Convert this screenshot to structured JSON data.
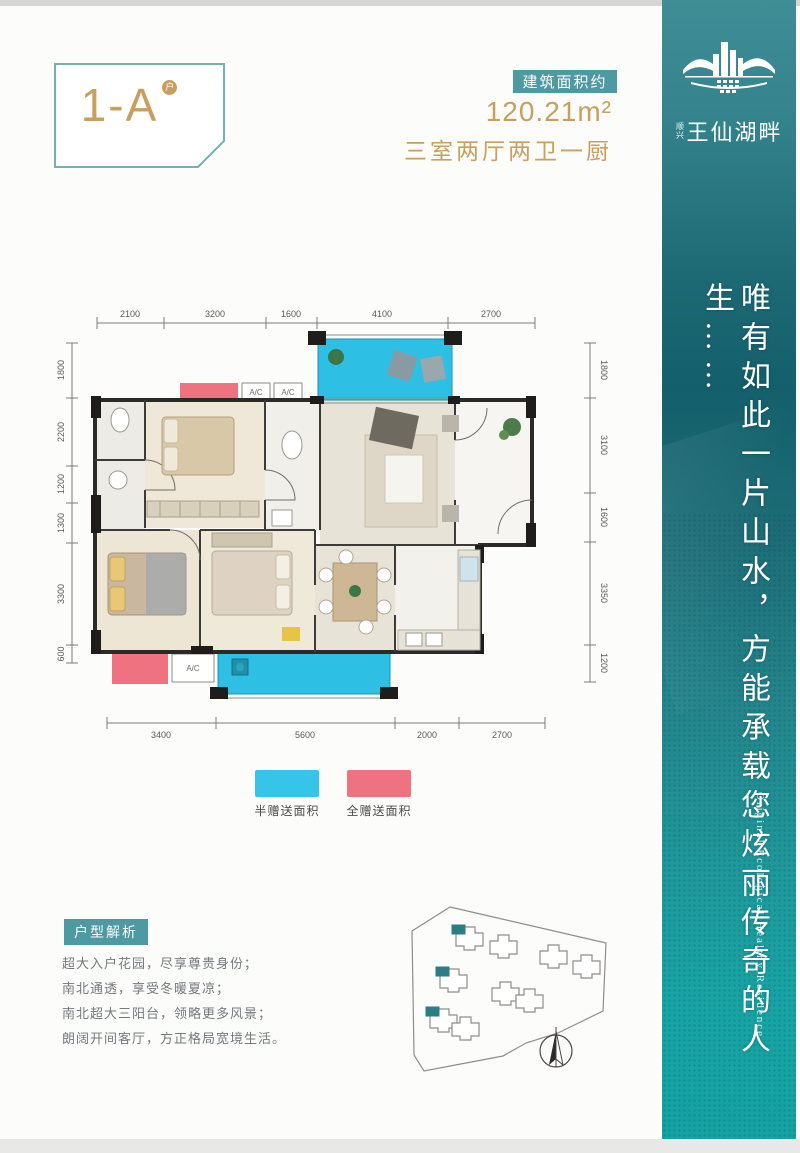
{
  "header": {
    "unit_label": "1-A",
    "unit_mark": "户",
    "area_badge": "建筑面积约",
    "area_value": "120.21m²",
    "rooms_desc": "三室两厅两卫一厨"
  },
  "brand": {
    "prefix": "顺兴",
    "name": "王仙湖畔",
    "slogan_cn": "唯有如此一片山水，方能承载您炫丽传奇的人生……",
    "slogan_en": "Original Ecological Healthy Residence"
  },
  "floorplan": {
    "ac_label": "A/C",
    "dims_top": [
      "2100",
      "3200",
      "1600",
      "4100",
      "2700"
    ],
    "dims_bottom": [
      "3400",
      "5600",
      "2000",
      "2700"
    ],
    "dims_left": [
      "1800",
      "2200",
      "1200",
      "1300",
      "3300",
      "600"
    ],
    "dims_right": [
      "1800",
      "3100",
      "1600",
      "3350",
      "1200"
    ]
  },
  "legend": {
    "items": [
      {
        "label": "半赠送面积",
        "color": "#35c5e8"
      },
      {
        "label": "全赠送面积",
        "color": "#ee7280"
      }
    ]
  },
  "analysis": {
    "title": "户型解析",
    "points": [
      "超大入户花园，尽享尊贵身份；",
      "南北通透，享受冬暖夏凉；",
      "南北超大三阳台，领略更多风景；",
      "朗阔开间客厅，方正格局宽境生活。"
    ]
  },
  "colors": {
    "accent_teal": "#4d9aa3",
    "gold": "#c7a05f",
    "balcony_cyan": "#2ebfe4",
    "gift_pink": "#ee7280",
    "sidebar_teal_top": "#3f8e96",
    "sidebar_teal_bottom": "#15a2a2"
  }
}
